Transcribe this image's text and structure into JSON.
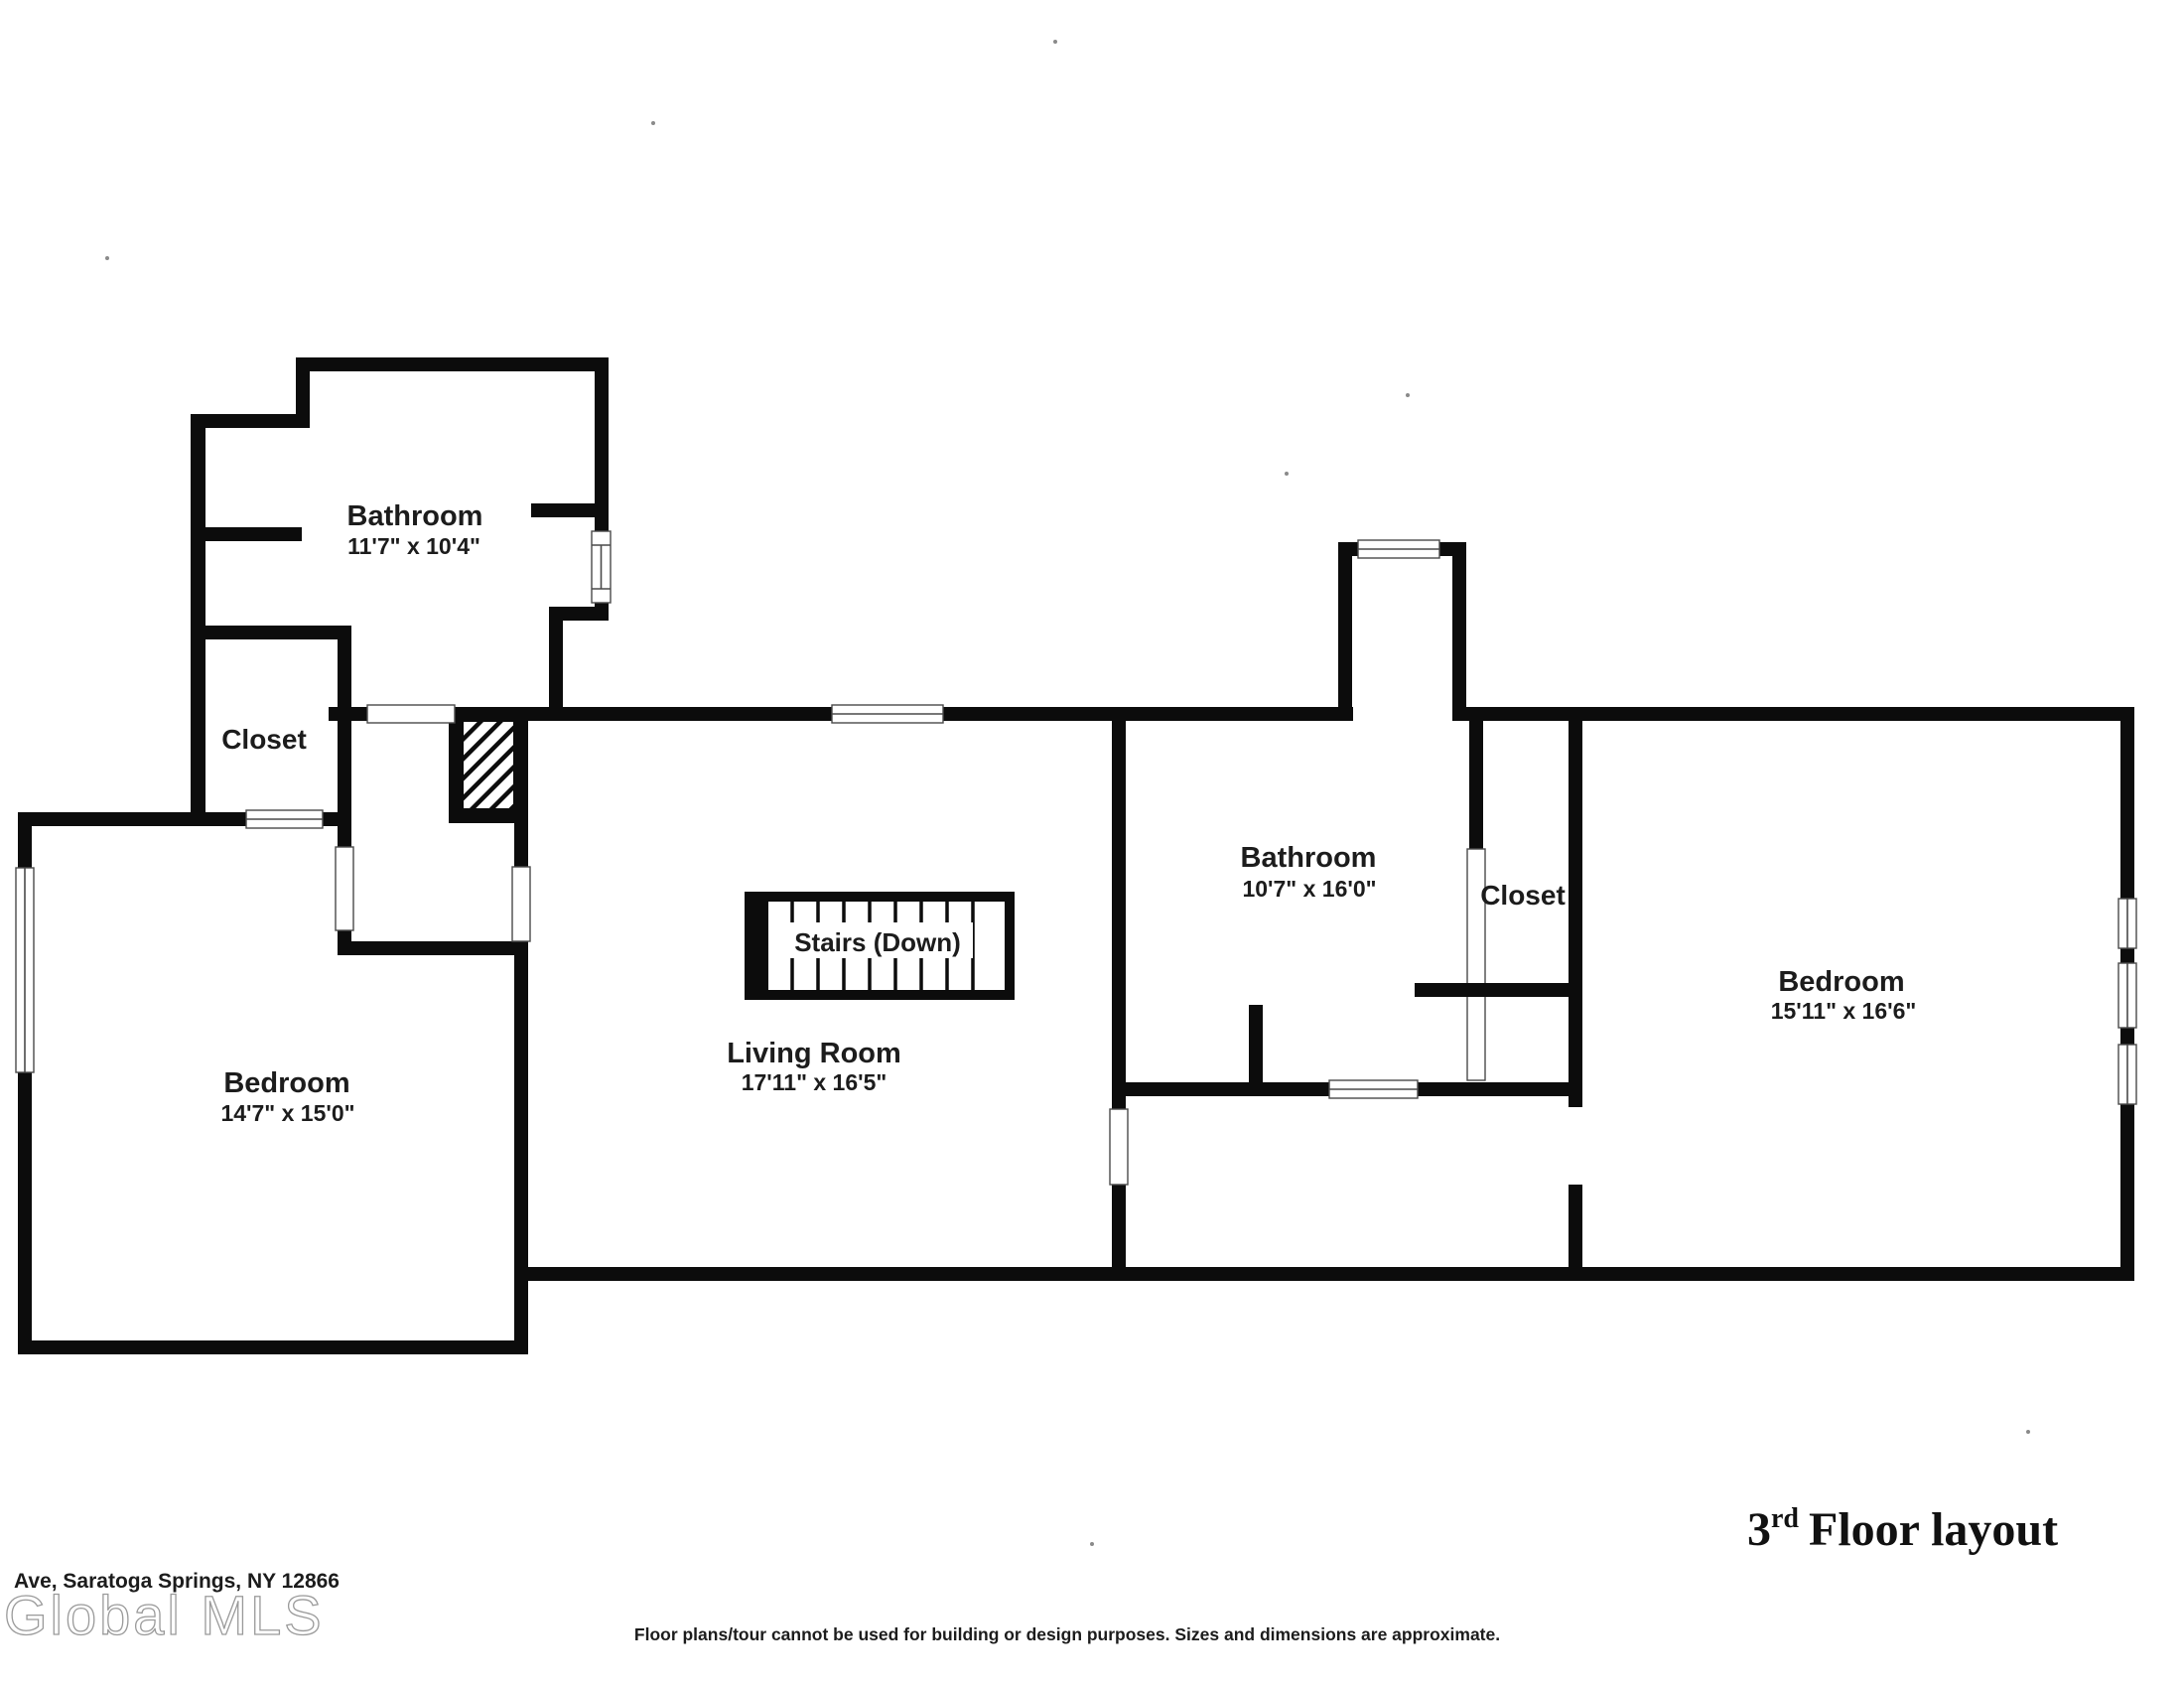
{
  "title": {
    "number": "3",
    "ordinal": "rd",
    "rest": "Floor layout"
  },
  "rooms": {
    "bathroom_upper": {
      "name": "Bathroom",
      "dims": "11'7\" x 10'4\""
    },
    "closet_upper": {
      "name": "Closet"
    },
    "bedroom_left": {
      "name": "Bedroom",
      "dims": "14'7\" x 15'0\""
    },
    "living_room": {
      "name": "Living Room",
      "dims": "17'11\" x 16'5\""
    },
    "stairs": {
      "name": "Stairs (Down)"
    },
    "bathroom_right": {
      "name": "Bathroom",
      "dims": "10'7\" x 16'0\""
    },
    "closet_right": {
      "name": "Closet"
    },
    "bedroom_right": {
      "name": "Bedroom",
      "dims": "15'11\" x 16'6\""
    }
  },
  "footer": {
    "address": "Ave, Saratoga Springs, NY 12866",
    "watermark": "Global MLS",
    "disclaimer": "Floor plans/tour cannot be used for building or design purposes. Sizes and dimensions are approximate."
  },
  "colors": {
    "wall": "#0c0c0c",
    "background": "#ffffff",
    "label_text": "#1c1c1c",
    "watermark_gray": "#9a9a9a"
  }
}
